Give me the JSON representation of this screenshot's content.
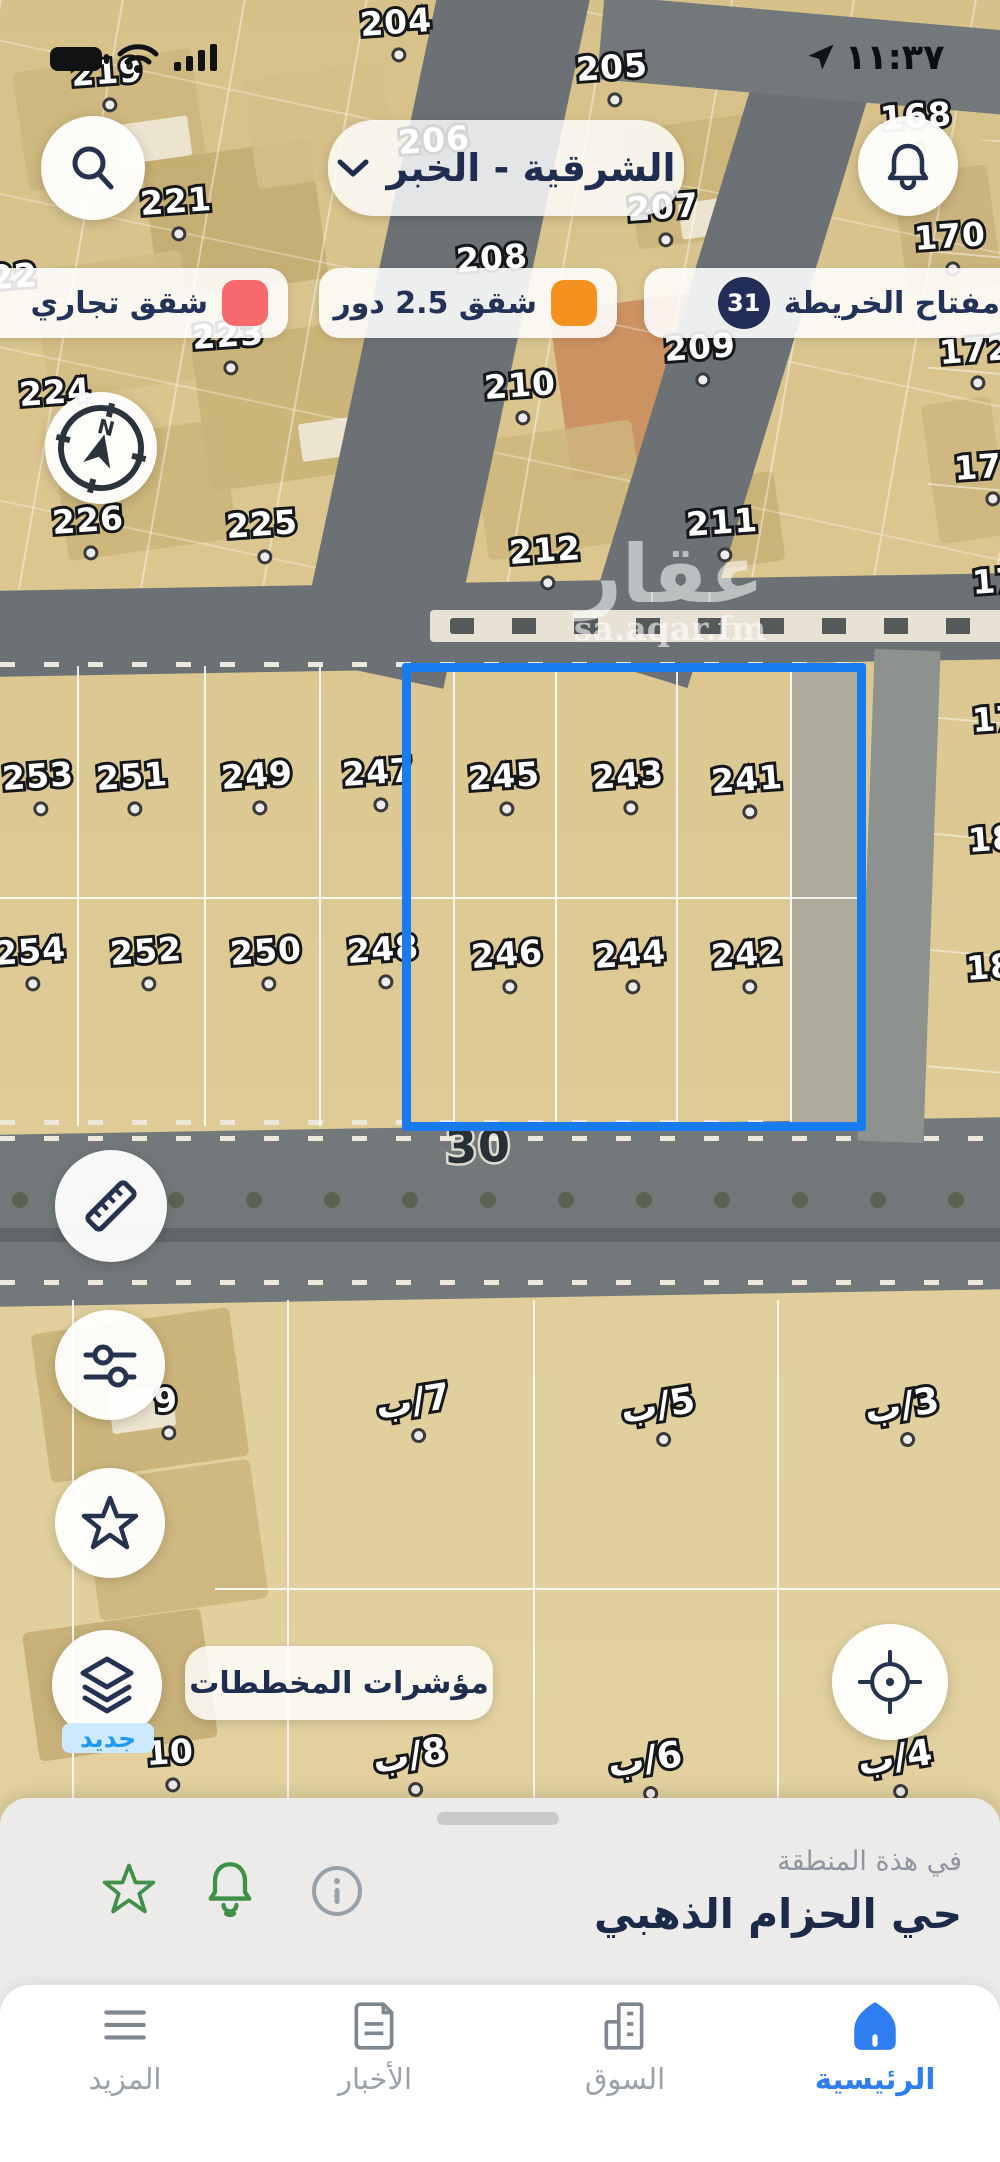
{
  "status_bar": {
    "time": "١١:٣٧"
  },
  "header": {
    "region_selector": {
      "label": "الشرقية - الخبر"
    }
  },
  "legend": {
    "key_label": "مفتاح الخريطة",
    "key_badge": "31",
    "items": [
      {
        "label": "شقق 2.5 دور",
        "color": "#f5921f"
      },
      {
        "label": "شقق تجاري",
        "color": "#f8696c"
      }
    ]
  },
  "map": {
    "selection_color": "#187bf0",
    "watermark_title": "عقار",
    "watermark_subtitle": "sa.aqar.fm",
    "street_label": "30",
    "plot_labels": [
      {
        "t": "219",
        "x": 107,
        "y": 72,
        "dot": true
      },
      {
        "t": "204",
        "x": 396,
        "y": 22,
        "dot": true
      },
      {
        "t": "205",
        "x": 612,
        "y": 67,
        "dot": true
      },
      {
        "t": "206",
        "x": 434,
        "y": 140,
        "dot": false
      },
      {
        "t": "207",
        "x": 663,
        "y": 207,
        "dot": true
      },
      {
        "t": "208",
        "x": 492,
        "y": 258,
        "dot": false
      },
      {
        "t": "209",
        "x": 700,
        "y": 347,
        "dot": true
      },
      {
        "t": "210",
        "x": 520,
        "y": 385,
        "dot": true
      },
      {
        "t": "211",
        "x": 722,
        "y": 522,
        "dot": true
      },
      {
        "t": "212",
        "x": 545,
        "y": 550,
        "dot": true
      },
      {
        "t": "221",
        "x": 176,
        "y": 201,
        "dot": true
      },
      {
        "t": "222",
        "x": 2,
        "y": 277,
        "dot": false
      },
      {
        "t": "223",
        "x": 228,
        "y": 335,
        "dot": true
      },
      {
        "t": "224",
        "x": 55,
        "y": 392,
        "dot": false
      },
      {
        "t": "225",
        "x": 262,
        "y": 524,
        "dot": true
      },
      {
        "t": "226",
        "x": 88,
        "y": 520,
        "dot": true
      },
      {
        "t": "168",
        "x": 916,
        "y": 116,
        "dot": true
      },
      {
        "t": "170",
        "x": 950,
        "y": 236,
        "dot": true
      },
      {
        "t": "172",
        "x": 975,
        "y": 350,
        "dot": true
      },
      {
        "t": "174",
        "x": 990,
        "y": 466,
        "dot": true
      },
      {
        "t": "176",
        "x": 1008,
        "y": 580,
        "dot": false
      },
      {
        "t": "178",
        "x": 1008,
        "y": 718,
        "dot": false
      },
      {
        "t": "180",
        "x": 1004,
        "y": 838,
        "dot": false
      },
      {
        "t": "182",
        "x": 1002,
        "y": 966,
        "dot": false
      },
      {
        "t": "253",
        "x": 38,
        "y": 776,
        "dot": true
      },
      {
        "t": "251",
        "x": 132,
        "y": 776,
        "dot": true
      },
      {
        "t": "249",
        "x": 257,
        "y": 775,
        "dot": true
      },
      {
        "t": "247",
        "x": 378,
        "y": 772,
        "dot": true
      },
      {
        "t": "245",
        "x": 504,
        "y": 776,
        "dot": true
      },
      {
        "t": "243",
        "x": 628,
        "y": 775,
        "dot": true
      },
      {
        "t": "241",
        "x": 747,
        "y": 779,
        "dot": true
      },
      {
        "t": "254",
        "x": 30,
        "y": 951,
        "dot": true
      },
      {
        "t": "252",
        "x": 146,
        "y": 951,
        "dot": true
      },
      {
        "t": "250",
        "x": 266,
        "y": 951,
        "dot": true
      },
      {
        "t": "248",
        "x": 383,
        "y": 949,
        "dot": true
      },
      {
        "t": "246",
        "x": 507,
        "y": 954,
        "dot": true
      },
      {
        "t": "244",
        "x": 630,
        "y": 954,
        "dot": true
      },
      {
        "t": "242",
        "x": 747,
        "y": 954,
        "dot": true
      },
      {
        "t": "30",
        "x": 478,
        "y": 1146,
        "dot": false,
        "cls": "street"
      },
      {
        "t": "9",
        "x": 166,
        "y": 1400,
        "dot": true
      },
      {
        "t": "7/ب",
        "x": 413,
        "y": 1402,
        "dot": true,
        "cls": "lotb"
      },
      {
        "t": "5/ب",
        "x": 658,
        "y": 1406,
        "dot": true,
        "cls": "lotb"
      },
      {
        "t": "3/ب",
        "x": 902,
        "y": 1406,
        "dot": true,
        "cls": "lotb"
      },
      {
        "t": "10",
        "x": 170,
        "y": 1752,
        "dot": true
      },
      {
        "t": "8/ب",
        "x": 410,
        "y": 1756,
        "dot": true,
        "cls": "lotb"
      },
      {
        "t": "6/ب",
        "x": 645,
        "y": 1760,
        "dot": true,
        "cls": "lotb"
      },
      {
        "t": "4/ب",
        "x": 895,
        "y": 1758,
        "dot": true,
        "cls": "lotb"
      }
    ]
  },
  "fab": {
    "new_badge": "جديد",
    "plans_label": "مؤشرات المخططات"
  },
  "bottom_sheet": {
    "caption": "في هذة المنطقة",
    "title": "حي الحزام الذهبي"
  },
  "nav": {
    "items": [
      {
        "label": "الرئيسية",
        "active": true
      },
      {
        "label": "السوق",
        "active": false
      },
      {
        "label": "الأخبار",
        "active": false
      },
      {
        "label": "المزيد",
        "active": false
      }
    ]
  }
}
